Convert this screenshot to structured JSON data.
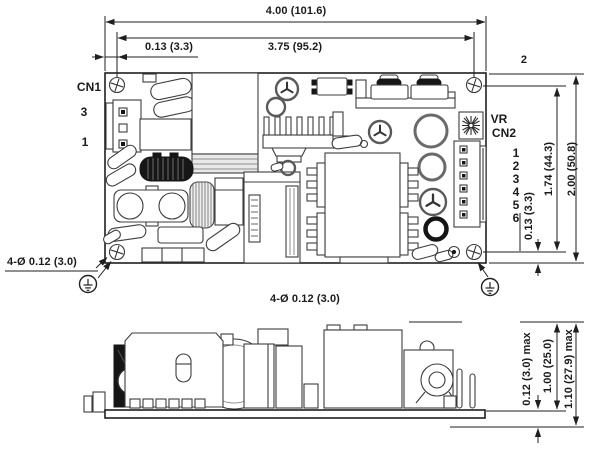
{
  "drawing": {
    "top_view": {
      "cn1_label": "CN1",
      "cn1_pin_top": "3",
      "cn1_pin_bottom": "1",
      "corner_note": "2",
      "vr_label": "VR",
      "cn2_label": "CN2",
      "cn2_pins": [
        "1",
        "2",
        "3",
        "4",
        "5",
        "6"
      ],
      "dim_overall_width": "4.00 (101.6)",
      "dim_hole_span_width": "3.75 (95.2)",
      "dim_edge_to_hole_left": "0.13 (3.3)",
      "dim_overall_height": "2.00 (50.8)",
      "dim_hole_span_height": "1.74 (44.3)",
      "dim_edge_to_hole_bottom": "0.13 (3.3)",
      "mounting_hole_callout": "4-Ø 0.12 (3.0)",
      "mounting_hole_note": "4-Ø 0.12 (3.0)"
    },
    "side_view": {
      "dim_pin_protrusion": "0.12 (3.0) max",
      "dim_component_height": "1.00 (25.0)",
      "dim_overall_height": "1.10 (27.9) max"
    },
    "colors": {
      "line": "#1f1f1f",
      "dark_fill": "#161616",
      "background": "#ffffff"
    }
  }
}
